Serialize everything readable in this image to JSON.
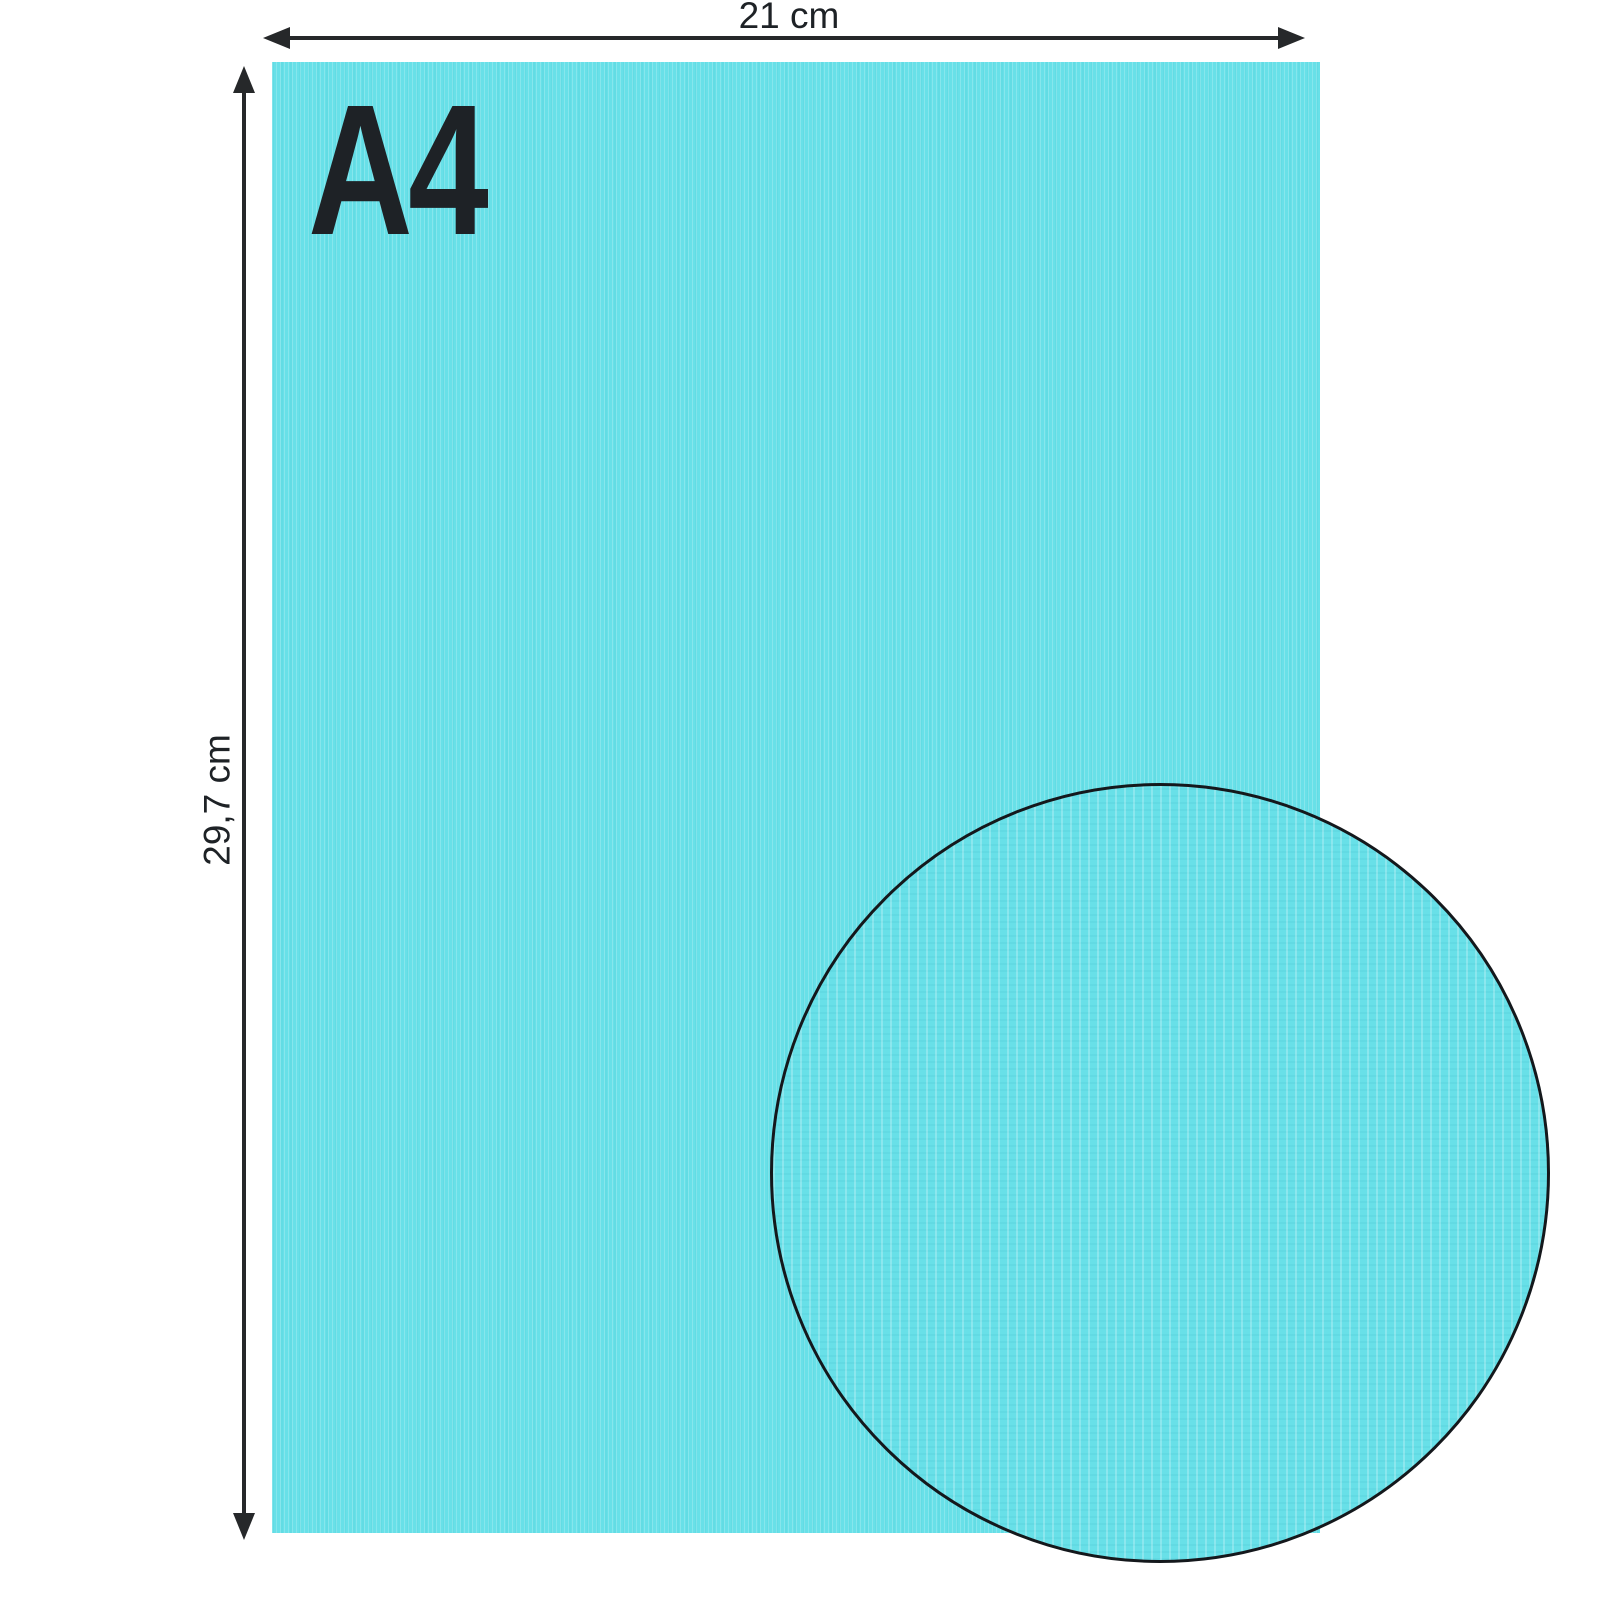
{
  "diagram": {
    "format_label": "A4",
    "width_label": "21 cm",
    "height_label": "29,7 cm"
  },
  "colors": {
    "background": "#ffffff",
    "paper": "#68e0e8",
    "arrow": "#26282a",
    "text": "#1e2226",
    "circle_border": "#14181c"
  }
}
